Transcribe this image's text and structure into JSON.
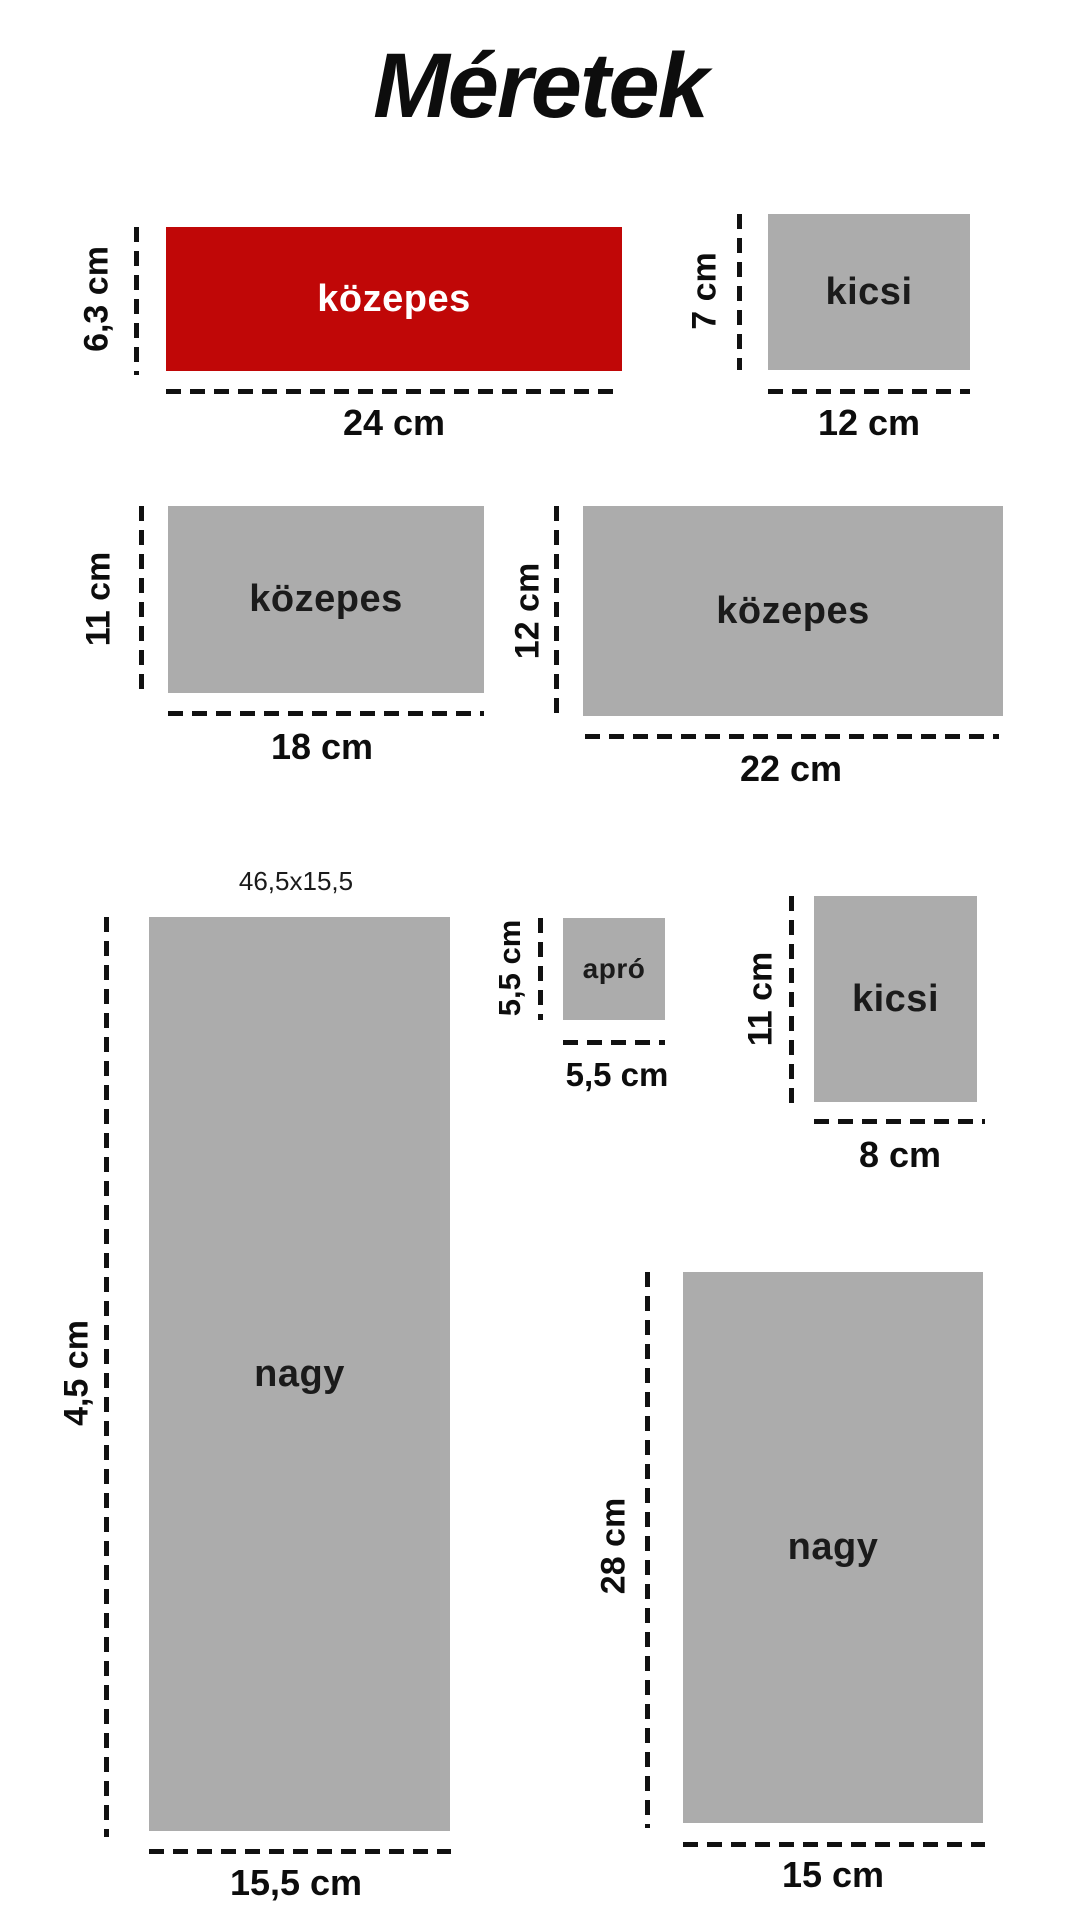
{
  "title": "Méretek",
  "note": "46,5x15,5",
  "colors": {
    "accent_red": "#C00707",
    "box_gray": "#ACACAC",
    "ink": "#111111"
  },
  "boxes": [
    {
      "label": "közepes",
      "height": "6,3 cm",
      "width": "24 cm",
      "color": "red"
    },
    {
      "label": "kicsi",
      "height": "7 cm",
      "width": "12 cm",
      "color": "gray"
    },
    {
      "label": "közepes",
      "height": "11 cm",
      "width": "18 cm",
      "color": "gray"
    },
    {
      "label": "közepes",
      "height": "12 cm",
      "width": "22 cm",
      "color": "gray"
    },
    {
      "label": "nagy",
      "height": "4,5 cm",
      "width": "15,5 cm",
      "color": "gray"
    },
    {
      "label": "apró",
      "height": "5,5 cm",
      "width": "5,5 cm",
      "color": "gray"
    },
    {
      "label": "kicsi",
      "height": "11 cm",
      "width": "8 cm",
      "color": "gray"
    },
    {
      "label": "nagy",
      "height": "28 cm",
      "width": "15 cm",
      "color": "gray"
    }
  ]
}
